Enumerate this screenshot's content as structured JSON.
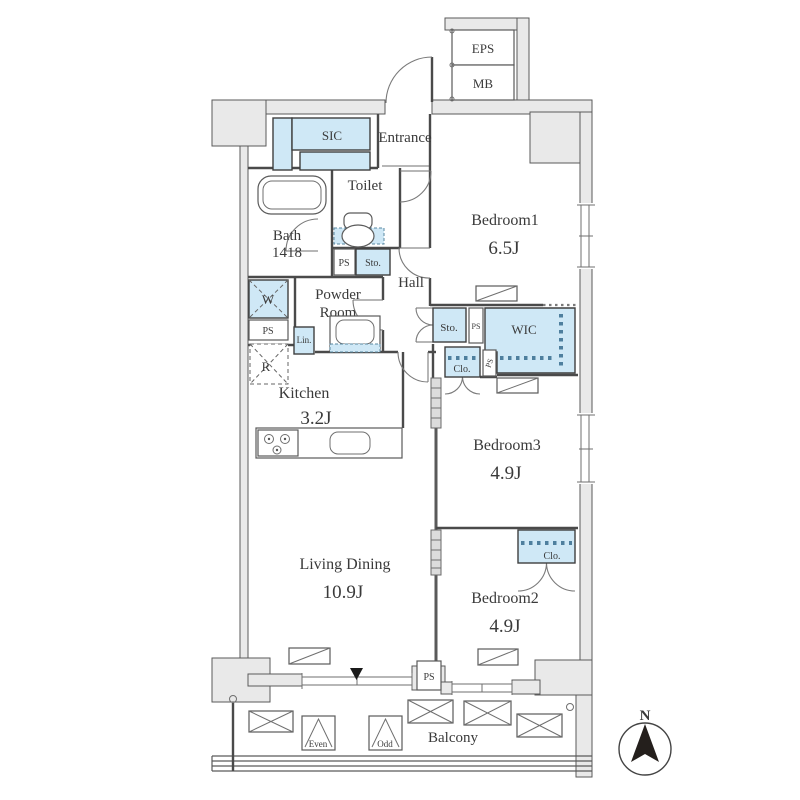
{
  "plan": {
    "rooms": {
      "bedroom1": {
        "name": "Bedroom1",
        "size": "6.5J"
      },
      "bedroom2": {
        "name": "Bedroom2",
        "size": "4.9J"
      },
      "bedroom3": {
        "name": "Bedroom3",
        "size": "4.9J"
      },
      "living_dining": {
        "name": "Living Dining",
        "size": "10.9J"
      },
      "kitchen": {
        "name": "Kitchen",
        "size": "3.2J"
      },
      "bath": {
        "name": "Bath",
        "size": "1418"
      },
      "toilet": "Toilet",
      "hall": "Hall",
      "powder_room": {
        "line1": "Powder",
        "line2": "Room"
      },
      "entrance": "Entrance",
      "balcony": "Balcony"
    },
    "storage": {
      "sic": "SIC",
      "wic": "WIC",
      "closet": "Clo.",
      "storage": "Sto.",
      "linen": "Lin."
    },
    "utility": {
      "ps": "PS",
      "eps": "EPS",
      "mb": "MB",
      "washer": "W",
      "fridge": "R"
    },
    "balcony_items": {
      "even": "Even",
      "odd": "Odd"
    },
    "compass": {
      "north": "N"
    }
  },
  "colors": {
    "fixture_blue": "#cfe8f6",
    "wall_gray": "#e9e9e9",
    "line": "#4a4a4a",
    "hanger_dots": "#4e7f9e"
  }
}
